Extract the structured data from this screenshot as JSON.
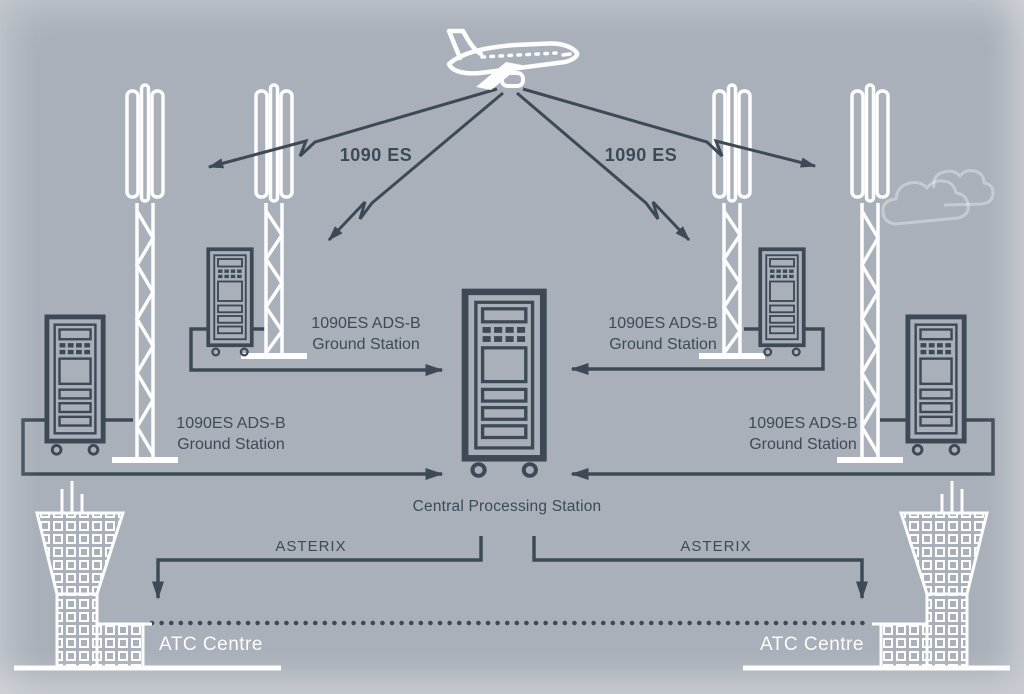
{
  "colors": {
    "background": "#a9b0b9",
    "ink": "#3d4a56",
    "white": "#fdfdfd"
  },
  "uplink": {
    "protocol_left": "1090 ES",
    "protocol_right": "1090 ES"
  },
  "ground_stations": {
    "inner_left": {
      "line1": "1090ES ADS-B",
      "line2": "Ground Station"
    },
    "outer_left": {
      "line1": "1090ES ADS-B",
      "line2": "Ground Station"
    },
    "inner_right": {
      "line1": "1090ES ADS-B",
      "line2": "Ground Station"
    },
    "outer_right": {
      "line1": "1090ES ADS-B",
      "line2": "Ground Station"
    }
  },
  "central_station": {
    "label": "Central Processing Station"
  },
  "downlink": {
    "protocol_left": "ASTERIX",
    "protocol_right": "ASTERIX"
  },
  "atc": {
    "left_label": "ATC Centre",
    "right_label": "ATC Centre"
  },
  "icons": {
    "aircraft": "airplane-outline",
    "tower": "lattice-antenna-tower",
    "ground_station": "server-rack",
    "central_station": "server-rack-large",
    "atc_building": "control-tower-building",
    "cloud": "cloud-outline"
  }
}
